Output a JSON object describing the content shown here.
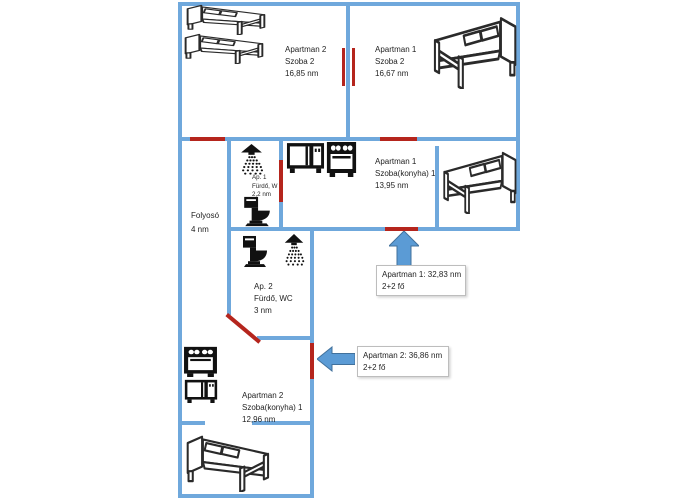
{
  "colors": {
    "background": "#ffffff",
    "wall": "#6fa8dc",
    "door": "#b5251d",
    "arrow_fill": "#5b9bd5",
    "arrow_edge": "#41719c",
    "callout_border": "#bdbdbd",
    "text": "#1f1f1f",
    "icon": "#111111"
  },
  "rooms": {
    "apartman2_szoba2": {
      "lines": [
        "Apartman 2",
        "Szoba 2",
        "16,85 nm"
      ]
    },
    "apartman1_szoba2": {
      "lines": [
        "Apartman 1",
        "Szoba 2",
        "16,67 nm"
      ]
    },
    "apartman1_szoba_konyha": {
      "lines": [
        "Apartman 1",
        "Szoba(konyha) 1",
        "13,95 nm"
      ]
    },
    "furdo1": {
      "lines": [
        "Ap. 1",
        "Fürdő, W",
        "2,2 nm"
      ]
    },
    "folyoso": {
      "lines": [
        "Folyosó",
        "4 nm"
      ]
    },
    "furdo2": {
      "lines": [
        "Ap. 2",
        "Fürdő, WC",
        "3 nm"
      ]
    },
    "apartman2_szoba_konyha": {
      "lines": [
        "Apartman 2",
        "Szoba(konyha) 1",
        "12,96 nm"
      ]
    }
  },
  "callouts": {
    "apartman1": {
      "line1": "Apartman 1: 32,83 nm",
      "line2": "2+2 fő"
    },
    "apartman2": {
      "line1": "Apartman 2: 36,86 nm",
      "line2": "2+2 fő"
    }
  },
  "icons": {
    "bed": "bed-icon",
    "shower": "shower-icon",
    "toilet": "toilet-icon",
    "stove": "stove-icon",
    "microwave": "microwave-icon",
    "arrow_up": "arrow-up-icon",
    "arrow_left": "arrow-left-icon"
  }
}
